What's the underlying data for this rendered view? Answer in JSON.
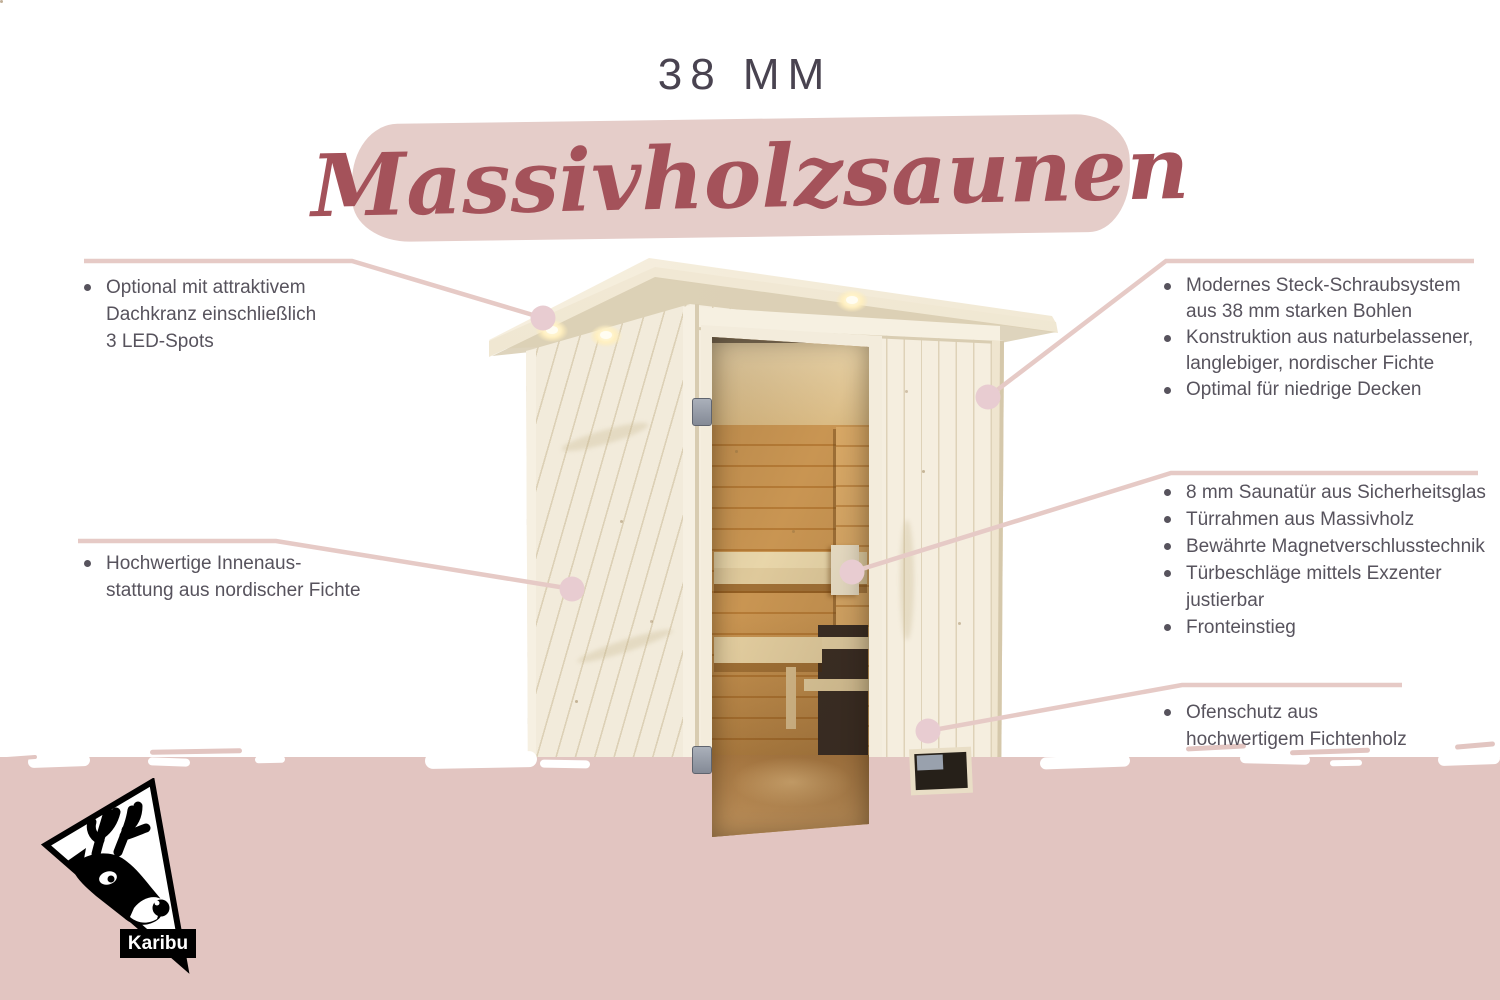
{
  "header": {
    "subtitle": "38 MM",
    "title": "Massivholzsaunen"
  },
  "callouts": {
    "top_left": {
      "rows": [
        {
          "bullet": true,
          "text": "Optional mit attraktivem"
        },
        {
          "bullet": false,
          "text": "Dachkranz einschließlich"
        },
        {
          "bullet": false,
          "text": "3 LED-Spots"
        }
      ]
    },
    "mid_left": {
      "rows": [
        {
          "bullet": true,
          "text": "Hochwertige Innenaus-"
        },
        {
          "bullet": false,
          "text": "stattung aus nordischer Fichte"
        }
      ]
    },
    "top_right": {
      "rows": [
        {
          "bullet": true,
          "text": "Modernes Steck-Schraubsystem"
        },
        {
          "bullet": false,
          "text": "aus 38 mm starken Bohlen"
        },
        {
          "bullet": true,
          "text": "Konstruktion aus naturbelassener,"
        },
        {
          "bullet": false,
          "text": "langlebiger, nordischer Fichte"
        },
        {
          "bullet": true,
          "text": "Optimal für niedrige Decken"
        }
      ]
    },
    "mid_right": {
      "rows": [
        {
          "bullet": true,
          "text": "8 mm Saunatür aus Sicherheitsglas"
        },
        {
          "bullet": true,
          "text": "Türrahmen aus Massivholz"
        },
        {
          "bullet": true,
          "text": "Bewährte Magnetverschlusstechnik"
        },
        {
          "bullet": true,
          "text": "Türbeschläge mittels Exzenter"
        },
        {
          "bullet": false,
          "text": "justierbar"
        },
        {
          "bullet": true,
          "text": "Fronteinstieg"
        }
      ]
    },
    "bottom_right": {
      "rows": [
        {
          "bullet": true,
          "text": "Ofenschutz aus"
        },
        {
          "bullet": false,
          "text": "hochwertigem Fichtenholz"
        }
      ]
    }
  },
  "logo": {
    "brand": "Karibu",
    "icon": "deer-head-icon"
  },
  "colors": {
    "band_pink": "#e5cdc9",
    "bottom_pink": "#e2c5c1",
    "connector": "#e6cac6",
    "dot_pink": "#e8ccd1",
    "headline_red": "#a4525a",
    "title_gray": "#494350",
    "text_gray": "#57535d",
    "logo_black": "#000000"
  }
}
